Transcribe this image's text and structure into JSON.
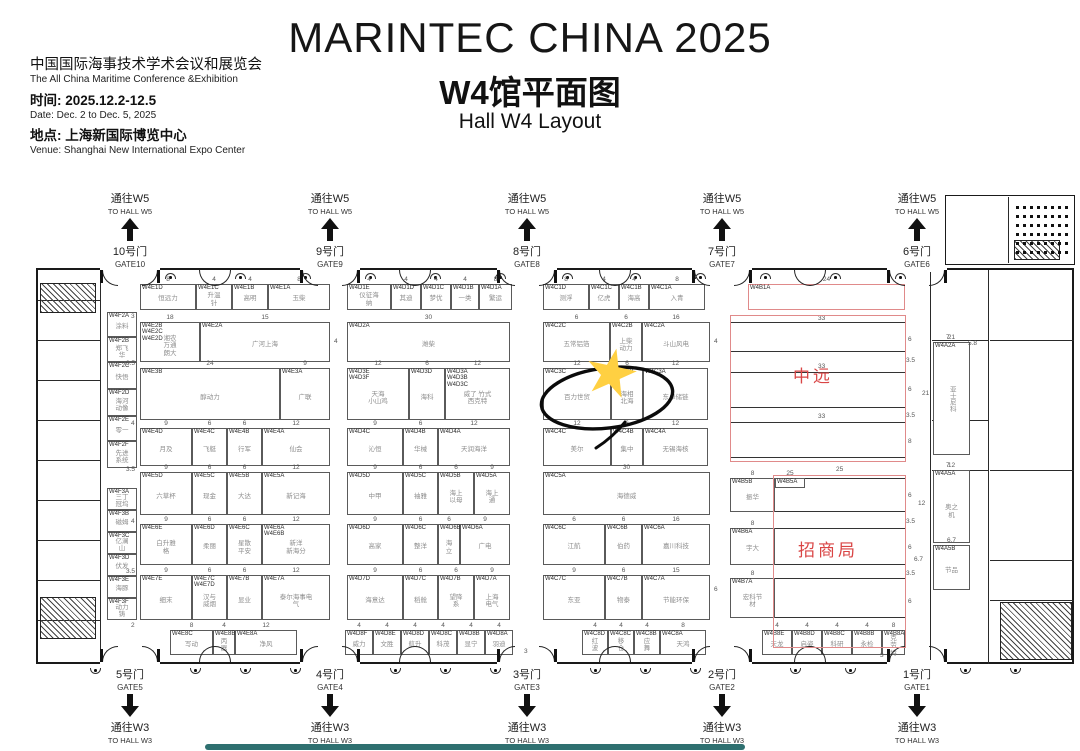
{
  "header": {
    "title": "MARINTEC CHINA 2025",
    "subtitle_cn": "W4馆平面图",
    "subtitle_en": "Hall W4 Layout",
    "org_cn": "中国国际海事技术学术会议和展览会",
    "org_en": "The All China Maritime Conference &Exhibition",
    "time_label": "时间: 2025.12.2-12.5",
    "date_en": "Date: Dec. 2 to Dec. 5, 2025",
    "venue_label": "地点: 上海新国际博览中心",
    "venue_en": "Venue: Shanghai New International Expo Center"
  },
  "colors": {
    "zone_red": "#d94545",
    "zone_outline": "#e08a8a",
    "star": "#ffd042",
    "wall": "#1a1a1a"
  },
  "annotation": {
    "star_color": "#ffd042",
    "highlighted_booth": "W4C3C"
  },
  "gates": {
    "top": [
      {
        "to": "通往W5",
        "to_en": "TO HALL W5",
        "door": "10号门",
        "gate": "GATE10",
        "x": 130
      },
      {
        "to": "通往W5",
        "to_en": "TO HALL W5",
        "door": "9号门",
        "gate": "GATE9",
        "x": 330
      },
      {
        "to": "通往W5",
        "to_en": "TO HALL W5",
        "door": "8号门",
        "gate": "GATE8",
        "x": 527
      },
      {
        "to": "通往W5",
        "to_en": "TO HALL W5",
        "door": "7号门",
        "gate": "GATE7",
        "x": 722
      },
      {
        "to": "通往W5",
        "to_en": "TO HALL W5",
        "door": "6号门",
        "gate": "GATE6",
        "x": 917
      }
    ],
    "bottom": [
      {
        "to": "通往W3",
        "to_en": "TO HALL W3",
        "door": "5号门",
        "gate": "GATE5",
        "x": 130
      },
      {
        "to": "通往W3",
        "to_en": "TO HALL W3",
        "door": "4号门",
        "gate": "GATE4",
        "x": 330
      },
      {
        "to": "通往W3",
        "to_en": "TO HALL W3",
        "door": "3号门",
        "gate": "GATE3",
        "x": 527
      },
      {
        "to": "通往W3",
        "to_en": "TO HALL W3",
        "door": "2号门",
        "gate": "GATE2",
        "x": 722
      },
      {
        "to": "通往W3",
        "to_en": "TO HALL W3",
        "door": "1号门",
        "gate": "GATE1",
        "x": 917
      }
    ]
  },
  "floorplan": {
    "zones": [
      {
        "key": "cosco",
        "label": "中远",
        "x": 730,
        "y": 315,
        "w": 176,
        "h": 147,
        "lx": 793,
        "ly": 362,
        "rows": [
          [
            730,
            322,
            176,
            30
          ],
          [
            730,
            372,
            176,
            36
          ],
          [
            730,
            422,
            176,
            36
          ]
        ]
      },
      {
        "key": "merchants",
        "label": "招商局",
        "x": 773,
        "y": 475,
        "w": 133,
        "h": 173,
        "lx": 798,
        "ly": 536,
        "rows": [
          [
            730,
            478,
            176,
            34
          ],
          [
            730,
            528,
            176,
            37
          ],
          [
            730,
            578,
            176,
            40
          ]
        ]
      }
    ],
    "booths": [
      [
        140,
        284,
        56,
        26,
        "W4E1D",
        "恒远力",
        "8"
      ],
      [
        196,
        284,
        36,
        26,
        "W4E1C",
        "升温针",
        "4"
      ],
      [
        232,
        284,
        36,
        26,
        "W4E1B",
        "高明",
        "4"
      ],
      [
        268,
        284,
        62,
        26,
        "W4E1A",
        "玉柴",
        "8"
      ],
      [
        347,
        284,
        44,
        26,
        "W4D1E",
        "仪征海纳",
        "4"
      ],
      [
        391,
        284,
        30,
        26,
        "W4D1D",
        "其迪",
        "4"
      ],
      [
        421,
        284,
        30,
        26,
        "W4D1C",
        "梦优",
        "4"
      ],
      [
        451,
        284,
        28,
        26,
        "W4D1B",
        "一类",
        "4"
      ],
      [
        479,
        284,
        33,
        26,
        "W4D1A",
        "繁运",
        "8"
      ],
      [
        543,
        284,
        46,
        26,
        "W4C1D",
        "测浮",
        "8"
      ],
      [
        589,
        284,
        30,
        26,
        "W4C1C",
        "亿虎",
        "4"
      ],
      [
        619,
        284,
        30,
        26,
        "W4C1B",
        "海高",
        "4"
      ],
      [
        649,
        284,
        56,
        26,
        "W4C1A",
        "入青",
        "8"
      ],
      [
        748,
        284,
        157,
        26,
        "W4B1A",
        "",
        "24",
        "red"
      ],
      [
        140,
        322,
        60,
        40,
        "W4E2B\nW4E2C\nW4E2D",
        "湘农\n万通\n朗大",
        "18"
      ],
      [
        200,
        322,
        130,
        40,
        "W4E2A",
        "广河上海",
        "15"
      ],
      [
        347,
        322,
        163,
        40,
        "W4D2A",
        "潍柴",
        "30"
      ],
      [
        543,
        322,
        67,
        40,
        "W4C2C",
        "五常铝箔",
        "6"
      ],
      [
        610,
        322,
        32,
        40,
        "W4C2B",
        "上柴动力",
        "6"
      ],
      [
        642,
        322,
        68,
        40,
        "W4C2A",
        "斗山风电",
        "16"
      ],
      [
        140,
        368,
        140,
        52,
        "W4E3B",
        "醇动力",
        "24"
      ],
      [
        280,
        368,
        50,
        52,
        "W4E3A",
        "广联",
        "9"
      ],
      [
        347,
        368,
        62,
        52,
        "W4D3E\nW4D3F",
        "天海\n小山鸡",
        "12"
      ],
      [
        409,
        368,
        36,
        52,
        "W4D3D",
        "海科",
        "6"
      ],
      [
        445,
        368,
        65,
        52,
        "W4D3A\nW4D3B\nW4D3C",
        "威了 竹式\n西克特",
        "12"
      ],
      [
        543,
        368,
        68,
        52,
        "W4C3C",
        "百力世贸",
        "12"
      ],
      [
        611,
        368,
        32,
        52,
        "W4C3B",
        "海相北海",
        "6"
      ],
      [
        643,
        368,
        65,
        52,
        "W4C3A",
        "东卓储链",
        "12"
      ],
      [
        140,
        428,
        52,
        38,
        "W4E4D",
        "月及",
        "9"
      ],
      [
        192,
        428,
        35,
        38,
        "W4E4C",
        "飞艇",
        "6"
      ],
      [
        227,
        428,
        35,
        38,
        "W4E4B",
        "行军",
        "6"
      ],
      [
        262,
        428,
        68,
        38,
        "W4E4A",
        "仙会",
        "12"
      ],
      [
        347,
        428,
        56,
        38,
        "W4D4C",
        "沁恒",
        "9"
      ],
      [
        403,
        428,
        35,
        38,
        "W4D4B",
        "华械",
        "6"
      ],
      [
        438,
        428,
        72,
        38,
        "W4D4A",
        "天润海洋",
        "12"
      ],
      [
        543,
        428,
        68,
        38,
        "W4C4C",
        "美尔",
        "12"
      ],
      [
        611,
        428,
        32,
        38,
        "W4C4B",
        "集中",
        "6"
      ],
      [
        643,
        428,
        65,
        38,
        "W4C4A",
        "无锡海核",
        "12"
      ],
      [
        140,
        472,
        52,
        43,
        "W4E5D",
        "六草杯",
        "9"
      ],
      [
        192,
        472,
        35,
        43,
        "W4E5C",
        "现金",
        "6"
      ],
      [
        227,
        472,
        35,
        43,
        "W4E5B",
        "大达",
        "6"
      ],
      [
        262,
        472,
        68,
        43,
        "W4E5A",
        "新记海",
        "12"
      ],
      [
        347,
        472,
        56,
        43,
        "W4D5D",
        "中甲",
        "9"
      ],
      [
        403,
        472,
        35,
        43,
        "W4D5C",
        "袖雅",
        "6"
      ],
      [
        438,
        472,
        36,
        43,
        "W4D5B",
        "海上以母",
        "6"
      ],
      [
        474,
        472,
        36,
        43,
        "W4D5A",
        "海上通",
        "9"
      ],
      [
        543,
        472,
        167,
        43,
        "W4C5A",
        "海德威",
        "30"
      ],
      [
        730,
        478,
        45,
        34,
        "W4B5B",
        "振华",
        "8"
      ],
      [
        775,
        478,
        30,
        10,
        "W4B5A",
        "",
        "25"
      ],
      [
        140,
        524,
        52,
        41,
        "W4E6E",
        "白升雅格",
        "9"
      ],
      [
        192,
        524,
        35,
        41,
        "W4E6D",
        "柔丽",
        "6"
      ],
      [
        227,
        524,
        35,
        41,
        "W4E6C",
        "星散平安",
        "6"
      ],
      [
        262,
        524,
        68,
        41,
        "W4E6A\nW4E6B",
        "新洋\n新海分",
        "12"
      ],
      [
        347,
        524,
        56,
        41,
        "W4D6D",
        "高家",
        "9"
      ],
      [
        403,
        524,
        35,
        41,
        "W4D6C",
        "整洋",
        "6"
      ],
      [
        438,
        524,
        22,
        41,
        "W4D6B",
        "海立",
        "6"
      ],
      [
        460,
        524,
        50,
        41,
        "W4D6A",
        "广电",
        "9"
      ],
      [
        543,
        524,
        62,
        41,
        "W4C6C",
        "江航",
        "6"
      ],
      [
        605,
        524,
        37,
        41,
        "W4C6B",
        "伯药",
        "6"
      ],
      [
        642,
        524,
        68,
        41,
        "W4C6A",
        "嘉川科技",
        "16"
      ],
      [
        730,
        528,
        45,
        37,
        "W4B6A",
        "宇大",
        "8"
      ],
      [
        140,
        575,
        52,
        45,
        "W4E7E",
        "细末",
        "9"
      ],
      [
        192,
        575,
        35,
        45,
        "W4E7C\nW4E7D",
        "汉与\n威烟",
        "6"
      ],
      [
        227,
        575,
        35,
        45,
        "W4E7B",
        "显业",
        "6"
      ],
      [
        262,
        575,
        68,
        45,
        "W4E7A",
        "泰尔海事电气",
        "12"
      ],
      [
        347,
        575,
        56,
        45,
        "W4D7D",
        "海意达",
        "9"
      ],
      [
        403,
        575,
        35,
        45,
        "W4D7C",
        "稻舱",
        "6"
      ],
      [
        438,
        575,
        36,
        45,
        "W4D7B",
        "望降系",
        "6"
      ],
      [
        474,
        575,
        36,
        45,
        "W4D7A",
        "上海电气",
        "9"
      ],
      [
        543,
        575,
        62,
        45,
        "W4C7C",
        "东亚",
        "9"
      ],
      [
        605,
        575,
        37,
        45,
        "W4C7B",
        "物泰",
        "6"
      ],
      [
        642,
        575,
        68,
        45,
        "W4C7A",
        "节能环保",
        "15"
      ],
      [
        730,
        578,
        45,
        40,
        "W4B7A",
        "宏科节材",
        "8"
      ],
      [
        170,
        630,
        43,
        25,
        "W4E8C",
        "写动",
        "8"
      ],
      [
        213,
        630,
        22,
        25,
        "W4E8B",
        "丙器",
        "4"
      ],
      [
        235,
        630,
        62,
        25,
        "W4E8A",
        "净风",
        "12"
      ],
      [
        345,
        630,
        28,
        25,
        "W4D8F",
        "威力",
        "4"
      ],
      [
        373,
        630,
        28,
        25,
        "W4D8E",
        "文胜",
        "4"
      ],
      [
        401,
        630,
        28,
        25,
        "W4D8D",
        "航升",
        "4"
      ],
      [
        429,
        630,
        28,
        25,
        "W4D8C",
        "科茂",
        "4"
      ],
      [
        457,
        630,
        28,
        25,
        "W4D8B",
        "显宁",
        "4"
      ],
      [
        485,
        630,
        28,
        25,
        "W4D8A",
        "羽迪",
        "4"
      ],
      [
        582,
        630,
        26,
        25,
        "W4C8D",
        "红波",
        "4"
      ],
      [
        608,
        630,
        26,
        25,
        "W4C8C",
        "移仓",
        "4"
      ],
      [
        634,
        630,
        26,
        25,
        "W4C8B",
        "应舞",
        "4"
      ],
      [
        660,
        630,
        46,
        25,
        "W4C8A",
        "天鸿",
        "8"
      ],
      [
        762,
        630,
        30,
        25,
        "W4B8E",
        "天龙",
        "4"
      ],
      [
        792,
        630,
        30,
        25,
        "W4B8D",
        "启姿",
        "4"
      ],
      [
        822,
        630,
        30,
        25,
        "W4B8C",
        "科研",
        "4"
      ],
      [
        852,
        630,
        30,
        25,
        "W4B8B",
        "永检",
        "4"
      ],
      [
        882,
        630,
        23,
        25,
        "W4B8A",
        "克劳特",
        "8"
      ],
      [
        107,
        312,
        30,
        25,
        "W4F2A",
        "涂料",
        ""
      ],
      [
        107,
        337,
        30,
        25,
        "W4F2B",
        "郑飞华",
        ""
      ],
      [
        107,
        362,
        30,
        27,
        "W4F2C",
        "快悟",
        ""
      ],
      [
        107,
        389,
        30,
        27,
        "W4F2D",
        "海河动像",
        ""
      ],
      [
        107,
        416,
        30,
        25,
        "W4F2E",
        "零一",
        ""
      ],
      [
        107,
        441,
        30,
        27,
        "W4F2F",
        "先进系统",
        ""
      ],
      [
        107,
        488,
        30,
        22,
        "W4F3A",
        "三丁冠坞",
        ""
      ],
      [
        107,
        510,
        30,
        22,
        "W4F3B",
        "磁姆",
        ""
      ],
      [
        107,
        532,
        30,
        22,
        "W4F3C",
        "亿澜山",
        ""
      ],
      [
        107,
        554,
        30,
        22,
        "W4F3D",
        "伏发",
        ""
      ],
      [
        107,
        576,
        30,
        22,
        "W4F3E",
        "海豚",
        ""
      ],
      [
        107,
        598,
        30,
        22,
        "W4F3F",
        "动力铸",
        ""
      ],
      [
        933,
        342,
        37,
        113,
        "W4A2A",
        "亚士尼科",
        "21",
        "v"
      ],
      [
        933,
        470,
        37,
        73,
        "W4A5A",
        "奥之机",
        "12"
      ],
      [
        933,
        545,
        37,
        45,
        "W4A5B",
        "节品",
        "6.7"
      ]
    ],
    "dims": [
      {
        "x": 818,
        "y": 315,
        "t": "33"
      },
      {
        "x": 818,
        "y": 363,
        "t": "33"
      },
      {
        "x": 818,
        "y": 413,
        "t": "33"
      },
      {
        "x": 836,
        "y": 466,
        "t": "25"
      },
      {
        "x": 908,
        "y": 336,
        "t": "6"
      },
      {
        "x": 906,
        "y": 357,
        "t": "3.5"
      },
      {
        "x": 908,
        "y": 386,
        "t": "6"
      },
      {
        "x": 906,
        "y": 412,
        "t": "3.5"
      },
      {
        "x": 908,
        "y": 438,
        "t": "8"
      },
      {
        "x": 908,
        "y": 492,
        "t": "6"
      },
      {
        "x": 906,
        "y": 518,
        "t": "3.5"
      },
      {
        "x": 908,
        "y": 544,
        "t": "6"
      },
      {
        "x": 906,
        "y": 570,
        "t": "3.5"
      },
      {
        "x": 908,
        "y": 598,
        "t": "6"
      },
      {
        "x": 880,
        "y": 652,
        "t": "3"
      },
      {
        "x": 968,
        "y": 340,
        "t": "5.8"
      },
      {
        "x": 914,
        "y": 556,
        "t": "6.7"
      },
      {
        "x": 918,
        "y": 500,
        "t": "12"
      },
      {
        "x": 922,
        "y": 390,
        "t": "21"
      },
      {
        "x": 946,
        "y": 334,
        "t": "7"
      },
      {
        "x": 946,
        "y": 462,
        "t": "7"
      },
      {
        "x": 131,
        "y": 313,
        "t": "3"
      },
      {
        "x": 126,
        "y": 360,
        "t": "3.5"
      },
      {
        "x": 131,
        "y": 420,
        "t": "4"
      },
      {
        "x": 126,
        "y": 466,
        "t": "3.5"
      },
      {
        "x": 131,
        "y": 518,
        "t": "4"
      },
      {
        "x": 126,
        "y": 568,
        "t": "3.5"
      },
      {
        "x": 131,
        "y": 622,
        "t": "2"
      },
      {
        "x": 524,
        "y": 648,
        "t": "3"
      },
      {
        "x": 334,
        "y": 338,
        "t": "4"
      },
      {
        "x": 714,
        "y": 338,
        "t": "4"
      },
      {
        "x": 714,
        "y": 586,
        "t": "6"
      }
    ]
  }
}
